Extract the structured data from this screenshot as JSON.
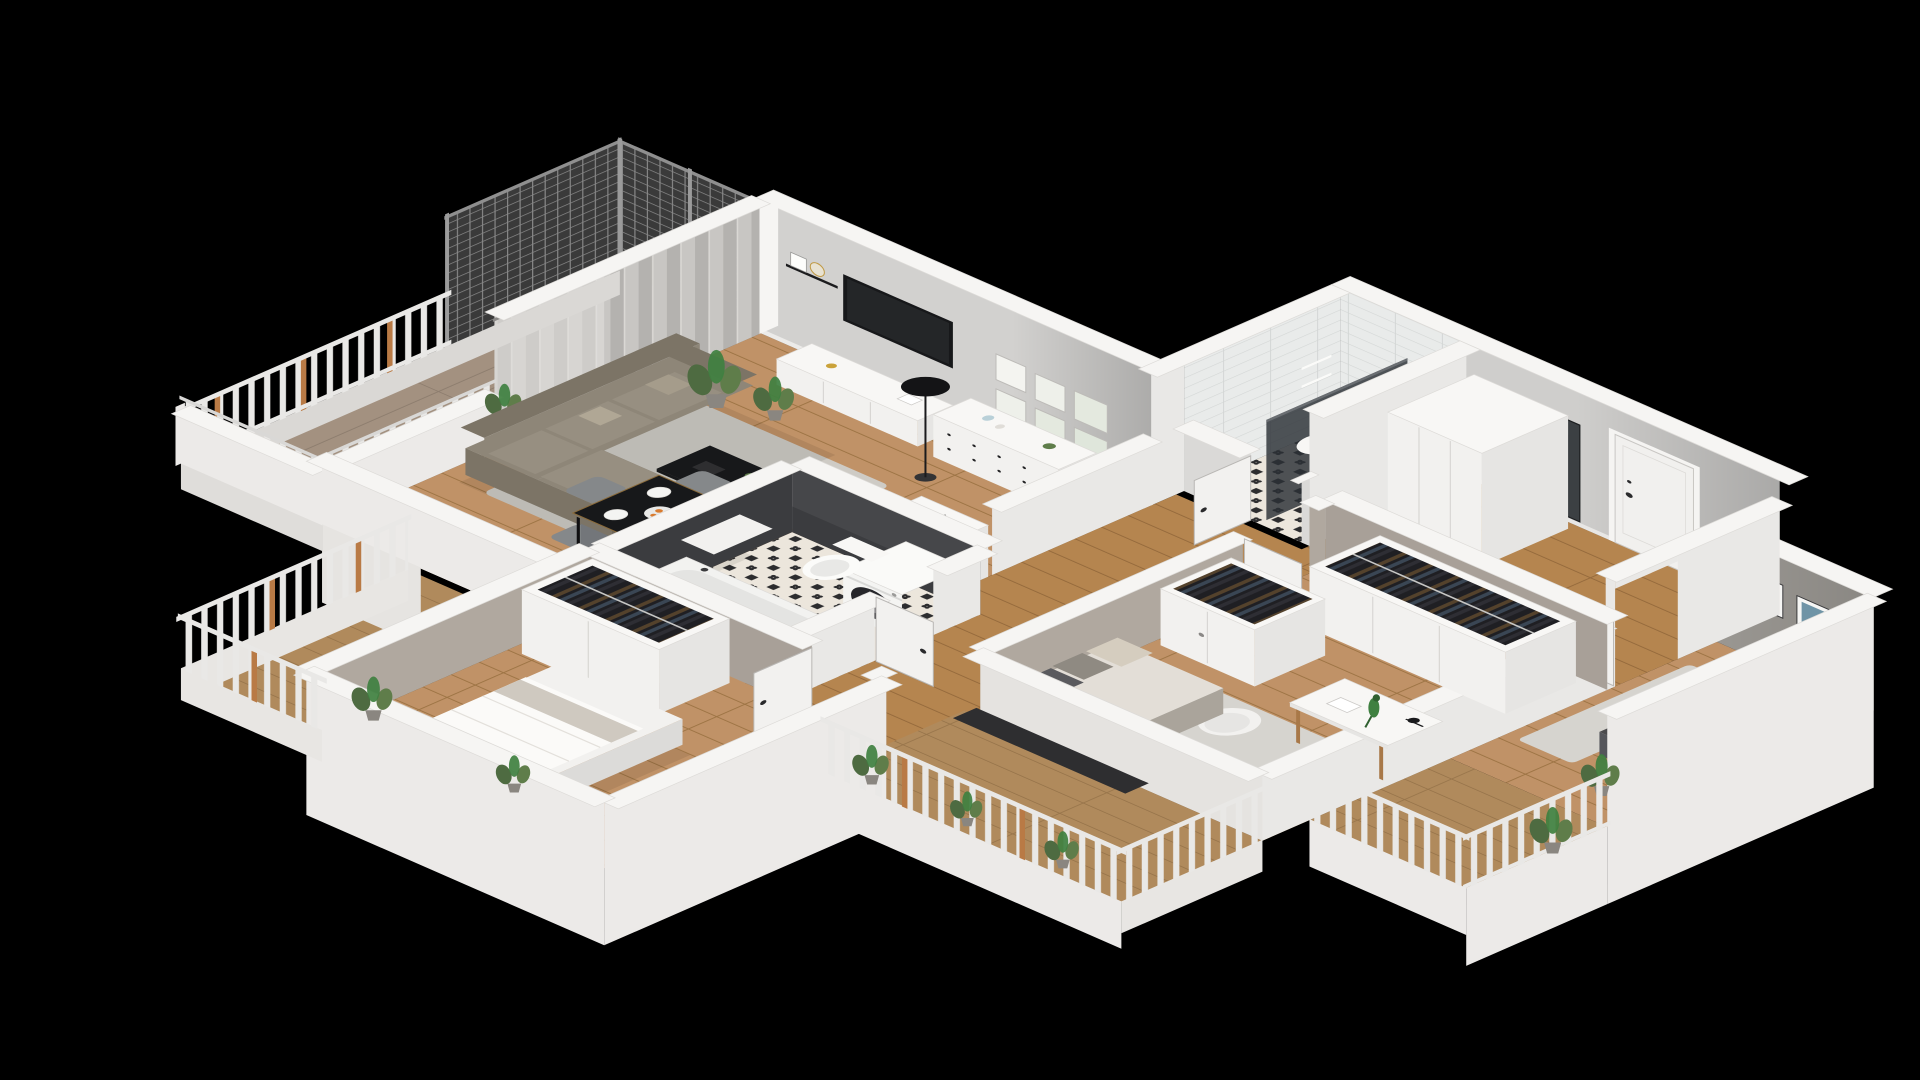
{
  "scene": {
    "type": "isometric-3d-floorplan-cutaway-render",
    "background_label": "black-void",
    "apartment": {
      "rooms": [
        {
          "name": "living-room",
          "floor": "wood-planks",
          "furniture": [
            "corner-sofa",
            "coffee-table",
            "area-rug",
            "floor-lamp",
            "tv",
            "tv-sideboard",
            "picture-ledge-shelf",
            "gallery-wall-frames",
            "white-dresser",
            "dining-table",
            "dining-chairs",
            "tableware",
            "potted-plants",
            "curtain-window-wall"
          ]
        },
        {
          "name": "kitchen",
          "floor": "wood-planks",
          "furniture": [
            "counter-with-cooktop",
            "sink",
            "fridge-column-with-snowflake-mark"
          ]
        },
        {
          "name": "main-bathroom",
          "floor": "ornamental-black-white-tile",
          "furniture": [
            "bathtub",
            "toilet",
            "washing-machine",
            "storage-cabinet"
          ]
        },
        {
          "name": "shower-room",
          "floor": "ornamental-black-white-tile",
          "furniture": [
            "glass-shower-screen",
            "corner-shelves",
            "wash-basin",
            "toilet"
          ]
        },
        {
          "name": "entry-hall",
          "floor": "wood-planks",
          "furniture": [
            "front-door-closed",
            "full-length-mirror",
            "tall-wardrobe"
          ]
        },
        {
          "name": "bedroom-small",
          "floor": "wood-planks",
          "furniture": [
            "single-bed",
            "teal-pillow",
            "dotted-throw",
            "two-art-frames",
            "area-rug",
            "potted-plant"
          ]
        },
        {
          "name": "bedroom-middle",
          "floor": "wood-planks",
          "furniture": [
            "daybed-with-pillows",
            "open-wardrobes-with-hanging-clothes",
            "desk",
            "desk-lamp",
            "parrot-figurine",
            "shell-chair",
            "area-rug"
          ]
        },
        {
          "name": "bedroom-master",
          "floor": "wood-planks",
          "furniture": [
            "double-bed",
            "open-wardrobe-with-hanging-clothes",
            "dark-side-table",
            "potted-plant"
          ]
        }
      ],
      "balconies": [
        {
          "name": "balcony-living",
          "features": [
            "metal-mesh-privacy-screens",
            "baluster-railing",
            "white-parapet-wall",
            "wood-deck",
            "potted-plant"
          ]
        },
        {
          "name": "balcony-master",
          "features": [
            "baluster-railing-with-wood-posts",
            "wood-deck",
            "potted-plants"
          ]
        },
        {
          "name": "balcony-bedrooms",
          "features": [
            "baluster-railing",
            "wood-deck",
            "planter-with-greenery"
          ]
        }
      ],
      "doors": {
        "open_interior_door_leaves": 6,
        "front_door_state": "closed"
      }
    }
  },
  "palette": {
    "background": "#000000",
    "cap": "#f6f5f3",
    "wall_in": "#d2d1cf",
    "wall_bright": "#e9e8e6",
    "wall_ext": "#eceae8",
    "accent_gray": "#9a9792",
    "taupe": "#a8a098",
    "taupe2": "#b0a89f",
    "bath_dark": "#46474a",
    "bath_dark2": "#3b3c3f",
    "wood_light": "#c09267",
    "wood_line": "#9d7444",
    "wood2_light": "#b5854f",
    "wood2_line": "#956a3c",
    "deck1": "#a39180",
    "deck1_line": "#8d7d6e",
    "deck2": "#b08a5c",
    "deck2_line": "#97744a",
    "tile_bg": "#ece6dc",
    "tile_dark": "#2c2c2e",
    "shower_tile": "#e9ebea",
    "shower_line": "#d3d6d5",
    "curt_a": "#c8c6c3",
    "curt_b": "#b4b2af",
    "rail_white": "#e9e8e6",
    "rail_wood": "#b97a45",
    "mesh_bg": "#3d3d3d",
    "mesh_line": "#8f8f8f",
    "glass": "#2b3036",
    "mirror": "#3c4043",
    "furn_white": "#f2f1ef",
    "furn_top": "#f8f7f5",
    "furn_side": "#e6e5e3",
    "sofa": "#8e8678",
    "sofa_dark": "#7c7466",
    "sofa_light": "#978f81",
    "rug": "#cecbc5",
    "rug2": "#d6d4cf",
    "dark": "#17181a",
    "chair": "#85888a",
    "chair_side": "#73767a",
    "mattress": "#f6f5f3",
    "duvet": "#fbfaf8",
    "blanket": "#dcdcda",
    "teal": "#2e5a6e",
    "pillow_dark": "#4b4b4d",
    "pillow_beige": "#d5cdbf",
    "green1": "#4e6b41",
    "green2": "#5f7d4a",
    "green3": "#3f8040",
    "pot": "#8a8680",
    "counter_wood": "#a87848",
    "clothes_bg": "#1f1f23",
    "clothes1": "#54422c",
    "clothes2": "#3a4654",
    "clothes3": "#2e2e34",
    "dot": "#8f8f8d",
    "art_blue": "#8fb0bf",
    "art_blue2": "#6f94a6",
    "orange": "#d97b2e"
  }
}
